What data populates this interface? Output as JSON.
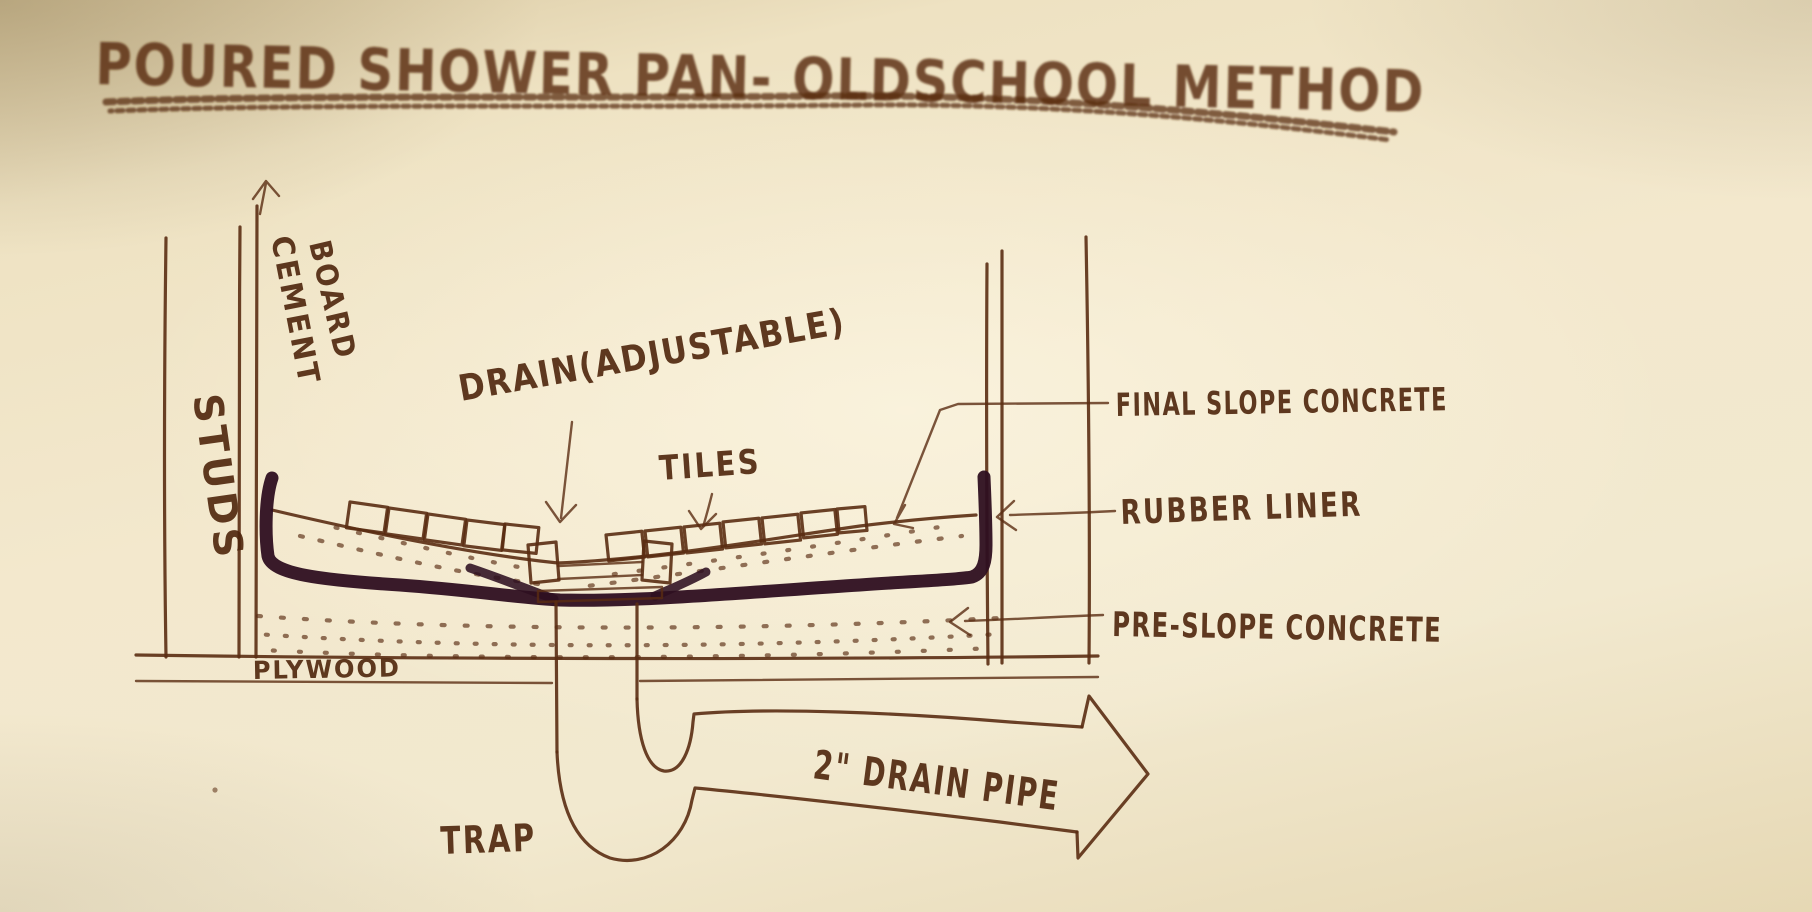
{
  "title": {
    "text": "POURED SHOWER PAN- OLDSCHOOL METHOD"
  },
  "labels": {
    "studs": "STUDS",
    "cement_board_line1": "CEMENT",
    "cement_board_line2": "BOARD",
    "drain": "DRAIN(ADJUSTABLE)",
    "tiles": "TILES",
    "final_slope_concrete": "FINAL SLOPE CONCRETE",
    "rubber_liner": "RUBBER LINER",
    "pre_slope_concrete": "PRE-SLOPE CONCRETE",
    "plywood": "PLYWOOD",
    "trap": "TRAP",
    "drain_pipe": "2\" DRAIN PIPE"
  },
  "colors": {
    "paper": "#f3e8cd",
    "ink": "#5a2c12",
    "ink_text": "#4e250c",
    "liner": "#2e0f20"
  }
}
